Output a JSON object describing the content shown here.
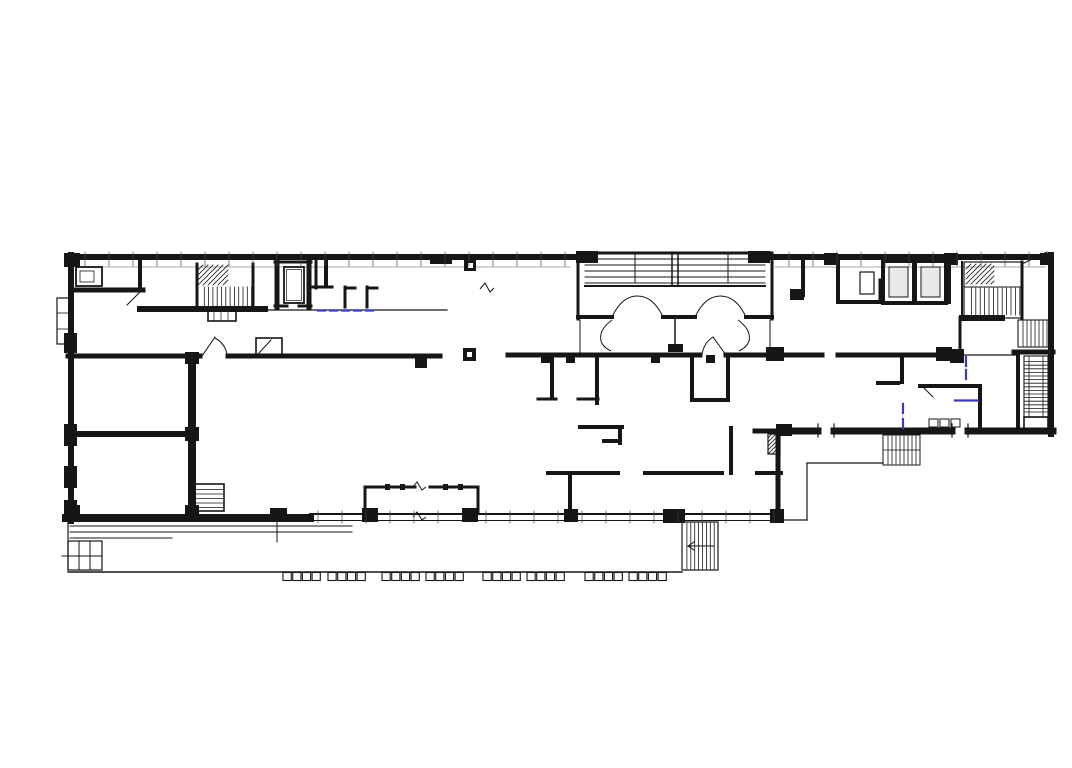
{
  "canvas": {
    "width": 1072,
    "height": 768,
    "background": "#ffffff"
  },
  "colors": {
    "ink": "#161616",
    "gray": "#8a8a8a",
    "blue_annotation": "#3a3ac0",
    "elevator_fill": "#e9e9e9",
    "paper": "#ffffff"
  },
  "floorplan": {
    "walls": [
      [
        68,
        257,
        578,
        257,
        6
      ],
      [
        772,
        257,
        1050,
        257,
        6
      ],
      [
        71,
        255,
        71,
        521,
        6
      ],
      [
        66,
        518,
        310,
        518,
        8
      ],
      [
        1051,
        255,
        1051,
        434,
        6
      ],
      [
        784,
        431,
        818,
        431,
        7
      ],
      [
        834,
        431,
        952,
        431,
        7
      ],
      [
        968,
        431,
        1053,
        431,
        7
      ],
      [
        755,
        431,
        784,
        431,
        5
      ],
      [
        778,
        433,
        778,
        519,
        5
      ],
      [
        578,
        253,
        578,
        319,
        3
      ],
      [
        772,
        253,
        772,
        319,
        3
      ],
      [
        578,
        253,
        772,
        253,
        3
      ],
      [
        578,
        317,
        612,
        317,
        4
      ],
      [
        663,
        317,
        695,
        317,
        4
      ],
      [
        746,
        317,
        772,
        317,
        4
      ],
      [
        72,
        290,
        143,
        290,
        5
      ],
      [
        140,
        258,
        140,
        290,
        4
      ],
      [
        140,
        309,
        265,
        309,
        6
      ],
      [
        197,
        264,
        197,
        308,
        3
      ],
      [
        253,
        264,
        253,
        308,
        3
      ],
      [
        277,
        260,
        277,
        307,
        5
      ],
      [
        309,
        260,
        309,
        307,
        5
      ],
      [
        275,
        262,
        311,
        262,
        3
      ],
      [
        275,
        306,
        287,
        306,
        3
      ],
      [
        299,
        306,
        311,
        306,
        3
      ],
      [
        316,
        258,
        316,
        288,
        3
      ],
      [
        313,
        287,
        332,
        287,
        3
      ],
      [
        326,
        262,
        326,
        286,
        4
      ],
      [
        345,
        307,
        345,
        287,
        3
      ],
      [
        345,
        288,
        355,
        288,
        3
      ],
      [
        367,
        307,
        367,
        287,
        3
      ],
      [
        367,
        288,
        377,
        288,
        3
      ],
      [
        68,
        356,
        200,
        356,
        5
      ],
      [
        228,
        356,
        440,
        356,
        5
      ],
      [
        192,
        356,
        192,
        518,
        8
      ],
      [
        68,
        434,
        192,
        434,
        6
      ],
      [
        508,
        355,
        700,
        355,
        5
      ],
      [
        726,
        355,
        822,
        355,
        5
      ],
      [
        838,
        355,
        952,
        355,
        5
      ],
      [
        552,
        355,
        552,
        398,
        4
      ],
      [
        597,
        355,
        597,
        403,
        4
      ],
      [
        538,
        399,
        556,
        399,
        3
      ],
      [
        578,
        399,
        598,
        399,
        3
      ],
      [
        580,
        427,
        622,
        427,
        4
      ],
      [
        620,
        427,
        620,
        443,
        4
      ],
      [
        620,
        441,
        604,
        441,
        4
      ],
      [
        548,
        473,
        618,
        473,
        4
      ],
      [
        570,
        473,
        570,
        508,
        4
      ],
      [
        645,
        473,
        722,
        473,
        4
      ],
      [
        757,
        473,
        781,
        473,
        4
      ],
      [
        692,
        358,
        692,
        398,
        4
      ],
      [
        692,
        400,
        726,
        400,
        4
      ],
      [
        728,
        358,
        728,
        400,
        4
      ],
      [
        731,
        428,
        731,
        473,
        4
      ],
      [
        902,
        355,
        902,
        382,
        4
      ],
      [
        878,
        383,
        898,
        383,
        4
      ],
      [
        920,
        386,
        980,
        386,
        4
      ],
      [
        980,
        386,
        980,
        428,
        4
      ],
      [
        838,
        258,
        838,
        302,
        4
      ],
      [
        838,
        302,
        882,
        302,
        4
      ],
      [
        880,
        280,
        880,
        302,
        3
      ],
      [
        803,
        258,
        803,
        295,
        4
      ],
      [
        949,
        258,
        949,
        302,
        4
      ],
      [
        962,
        318,
        1002,
        318,
        6
      ],
      [
        962,
        262,
        962,
        318,
        2
      ],
      [
        1022,
        262,
        1022,
        318,
        3
      ],
      [
        960,
        318,
        960,
        356,
        3
      ],
      [
        1014,
        352,
        1053,
        352,
        5
      ],
      [
        1018,
        352,
        1018,
        430,
        4
      ],
      [
        365,
        487,
        415,
        487,
        3
      ],
      [
        430,
        487,
        478,
        487,
        3
      ],
      [
        365,
        487,
        365,
        513,
        3
      ],
      [
        478,
        487,
        478,
        513,
        3
      ]
    ],
    "thin": [
      [
        585,
        259,
        765,
        259,
        1
      ],
      [
        585,
        265,
        765,
        265,
        1
      ],
      [
        585,
        271,
        765,
        271,
        1
      ],
      [
        585,
        277,
        765,
        277,
        1
      ],
      [
        585,
        283,
        765,
        283,
        1
      ],
      [
        585,
        286,
        765,
        286,
        2
      ],
      [
        635,
        255,
        635,
        283,
        1
      ],
      [
        728,
        255,
        728,
        283,
        1
      ],
      [
        672,
        253,
        672,
        285,
        1.5
      ],
      [
        678,
        253,
        678,
        285,
        1.5
      ],
      [
        580,
        320,
        580,
        352,
        1
      ],
      [
        770,
        320,
        770,
        352,
        1
      ],
      [
        675,
        319,
        675,
        348,
        1.5
      ],
      [
        265,
        310,
        447,
        310,
        1.2
      ],
      [
        310,
        514,
        783,
        514,
        2
      ],
      [
        310,
        520.5,
        783,
        520.5,
        1
      ],
      [
        68,
        522,
        68,
        570,
        1.2
      ],
      [
        68,
        572,
        682,
        572,
        1.4
      ],
      [
        70,
        526,
        352,
        526,
        1
      ],
      [
        70,
        532,
        352,
        532,
        1
      ],
      [
        70,
        538,
        172,
        538,
        1
      ],
      [
        79,
        541,
        79,
        570,
        1
      ],
      [
        90,
        541,
        90,
        570,
        1
      ],
      [
        62,
        556,
        102,
        556,
        1
      ],
      [
        277,
        522,
        277,
        542,
        1
      ],
      [
        688,
        546,
        714,
        546,
        1
      ],
      [
        688,
        546,
        694,
        542,
        1
      ],
      [
        688,
        546,
        694,
        550,
        1
      ],
      [
        783,
        520,
        807,
        520,
        1.2
      ],
      [
        807,
        463,
        807,
        520,
        1.2
      ],
      [
        807,
        463,
        883,
        463,
        1.2
      ],
      [
        883,
        450,
        920,
        450,
        0.8
      ],
      [
        818,
        424,
        818,
        437,
        1.2
      ],
      [
        834,
        424,
        834,
        437,
        1.2
      ],
      [
        952,
        424,
        952,
        437,
        1.2
      ],
      [
        968,
        424,
        968,
        437,
        1.2
      ],
      [
        1024,
        263,
        1047,
        252,
        1.2
      ],
      [
        964,
        287,
        1022,
        287,
        1
      ],
      [
        1029,
        357,
        1029,
        416,
        0.8
      ],
      [
        1043,
        357,
        1043,
        416,
        0.8
      ],
      [
        214,
        311,
        214,
        321,
        0.7
      ],
      [
        221,
        311,
        221,
        321,
        0.7
      ],
      [
        228,
        311,
        228,
        321,
        0.7
      ],
      [
        57,
        313,
        69,
        313,
        0.8
      ],
      [
        57,
        329,
        69,
        329,
        0.8
      ],
      [
        202,
        356,
        215,
        337,
        1
      ],
      [
        726,
        355,
        713,
        337,
        1
      ],
      [
        140,
        292,
        127,
        305,
        1
      ],
      [
        922,
        386,
        933,
        397,
        1
      ],
      [
        258,
        354,
        271,
        340,
        1
      ],
      [
        952,
        355,
        1016,
        355,
        1.2
      ]
    ],
    "gray": [
      [
        80,
        267,
        570,
        267,
        0.8
      ],
      [
        775,
        267,
        1045,
        267,
        0.8
      ]
    ],
    "rects": [
      {
        "x": 284,
        "y": 267,
        "w": 20,
        "h": 36,
        "sw": 1.8,
        "fill": "none"
      },
      {
        "x": 286.5,
        "y": 269.5,
        "w": 15,
        "h": 31,
        "sw": 0.7,
        "fill": "none"
      },
      {
        "x": 883,
        "y": 261,
        "w": 31,
        "h": 42,
        "sw": 4,
        "fill": "none"
      },
      {
        "x": 889,
        "y": 267,
        "w": 19,
        "h": 30,
        "sw": 1,
        "fill": "#e9e9e9"
      },
      {
        "x": 915,
        "y": 261,
        "w": 31,
        "h": 42,
        "sw": 4,
        "fill": "none"
      },
      {
        "x": 921,
        "y": 267,
        "w": 19,
        "h": 30,
        "sw": 1,
        "fill": "#e9e9e9"
      },
      {
        "x": 76,
        "y": 267,
        "w": 26,
        "h": 19,
        "sw": 1.8,
        "fill": "none"
      },
      {
        "x": 80,
        "y": 271,
        "w": 14,
        "h": 11,
        "sw": 0.8,
        "fill": "none"
      },
      {
        "x": 256,
        "y": 338,
        "w": 26,
        "h": 18,
        "sw": 1.6,
        "fill": "none"
      },
      {
        "x": 194,
        "y": 484,
        "w": 30,
        "h": 27,
        "sw": 1.6,
        "fill": "none"
      },
      {
        "x": 768,
        "y": 434,
        "w": 12,
        "h": 20,
        "sw": 1.2,
        "fill": "none"
      },
      {
        "x": 208,
        "y": 311,
        "w": 28,
        "h": 10,
        "sw": 1.6,
        "fill": "none"
      },
      {
        "x": 860,
        "y": 272,
        "w": 14,
        "h": 22,
        "sw": 1.2,
        "fill": "none"
      },
      {
        "x": 57,
        "y": 298,
        "w": 12,
        "h": 46,
        "sw": 1.2,
        "fill": "none"
      },
      {
        "x": 68,
        "y": 541,
        "w": 34,
        "h": 29,
        "sw": 1.2,
        "fill": "none"
      },
      {
        "x": 682,
        "y": 522,
        "w": 36,
        "h": 48,
        "sw": 1.2,
        "fill": "none"
      },
      {
        "x": 883,
        "y": 435,
        "w": 37,
        "h": 30,
        "sw": 1,
        "fill": "none"
      },
      {
        "x": 964,
        "y": 262,
        "w": 58,
        "h": 56,
        "sw": 1.2,
        "fill": "none"
      },
      {
        "x": 1018,
        "y": 320,
        "w": 34,
        "h": 27,
        "sw": 1.1,
        "fill": "none"
      },
      {
        "x": 1024,
        "y": 356,
        "w": 24,
        "h": 61,
        "sw": 1.1,
        "fill": "none"
      },
      {
        "x": 1024,
        "y": 417,
        "w": 24,
        "h": 12,
        "sw": 1.6,
        "fill": "none"
      },
      {
        "x": 929,
        "y": 419,
        "w": 9,
        "h": 8,
        "sw": 1,
        "fill": "none"
      },
      {
        "x": 940,
        "y": 419,
        "w": 9,
        "h": 8,
        "sw": 1,
        "fill": "none"
      },
      {
        "x": 951,
        "y": 419,
        "w": 9,
        "h": 8,
        "sw": 1,
        "fill": "none"
      }
    ],
    "blocks": [
      [
        576,
        251,
        22,
        12
      ],
      [
        748,
        251,
        22,
        12
      ],
      [
        430,
        254,
        22,
        10
      ],
      [
        464,
        260,
        12,
        11
      ],
      [
        463,
        348,
        13,
        13
      ],
      [
        766,
        347,
        18,
        14
      ],
      [
        936,
        347,
        16,
        14
      ],
      [
        950,
        349,
        14,
        14
      ],
      [
        541,
        355,
        9,
        8
      ],
      [
        566,
        355,
        9,
        8
      ],
      [
        651,
        355,
        9,
        8
      ],
      [
        706,
        355,
        9,
        8
      ],
      [
        270,
        508,
        17,
        14
      ],
      [
        362,
        508,
        16,
        14
      ],
      [
        462,
        508,
        16,
        14
      ],
      [
        564,
        509,
        14,
        13
      ],
      [
        663,
        509,
        22,
        14
      ],
      [
        770,
        509,
        14,
        14
      ],
      [
        64,
        333,
        13,
        20
      ],
      [
        64,
        424,
        13,
        22
      ],
      [
        64,
        466,
        13,
        22
      ],
      [
        64,
        500,
        13,
        20
      ],
      [
        64,
        253,
        16,
        14
      ],
      [
        185,
        352,
        14,
        12
      ],
      [
        185,
        427,
        14,
        14
      ],
      [
        185,
        505,
        14,
        13
      ],
      [
        64,
        505,
        16,
        15
      ],
      [
        668,
        344,
        15,
        8
      ],
      [
        790,
        289,
        14,
        11
      ],
      [
        776,
        424,
        16,
        12
      ],
      [
        824,
        253,
        14,
        12
      ],
      [
        944,
        253,
        14,
        12
      ],
      [
        1040,
        253,
        13,
        12
      ],
      [
        385,
        484,
        5,
        6
      ],
      [
        400,
        484,
        5,
        6
      ],
      [
        443,
        484,
        5,
        6
      ],
      [
        458,
        484,
        5,
        6
      ],
      [
        415,
        358,
        12,
        10
      ]
    ],
    "white_rects": [
      [
        467,
        352,
        5,
        5
      ],
      [
        468,
        263,
        5,
        5
      ]
    ],
    "hatches": [
      {
        "x": 198,
        "y": 265,
        "w": 30,
        "h": 20,
        "dir": "d",
        "step": 5
      },
      {
        "x": 200,
        "y": 287,
        "w": 52,
        "h": 21,
        "dir": "v",
        "step": 4.3
      },
      {
        "x": 195,
        "y": 485,
        "w": 28,
        "h": 25,
        "dir": "h",
        "step": 4.5
      },
      {
        "x": 966,
        "y": 264,
        "w": 28,
        "h": 20,
        "dir": "d",
        "step": 5
      },
      {
        "x": 967,
        "y": 288,
        "w": 53,
        "h": 27,
        "dir": "v",
        "step": 4.4
      },
      {
        "x": 1019,
        "y": 321,
        "w": 32,
        "h": 25,
        "dir": "v",
        "step": 4
      },
      {
        "x": 1025,
        "y": 358,
        "w": 22,
        "h": 57,
        "dir": "h",
        "step": 3.6
      },
      {
        "x": 683,
        "y": 523,
        "w": 34,
        "h": 46,
        "dir": "v",
        "step": 3.9
      },
      {
        "x": 884,
        "y": 436,
        "w": 35,
        "h": 28,
        "dir": "v",
        "step": 4
      },
      {
        "x": 768,
        "y": 434,
        "w": 12,
        "h": 20,
        "dir": "d",
        "step": 4
      }
    ],
    "paths": [
      "M612 317 C619 302 628 296 637.5 296 C647 296 656 302 663 317",
      "M695 317 C702 302 711 296 720.5 296 C730 296 739 302 746 317",
      "M612 320 C598 330 596 344 611 351",
      "M738 320 C752 330 754 344 739 351",
      "M215 338 A24 24 0 0 1 227 354",
      "M713 337 A25 25 0 0 0 702 355",
      "M413 487 l4 -5 l5 8 l4 -3",
      "M413 517 l4 -5 l5 8 l4 -3",
      "M480 289 l5 -6 l5 9 l4 -4"
    ],
    "blue_marks": [
      {
        "x1": 318,
        "y1": 310.5,
        "x2": 378,
        "y2": 310.5,
        "dash": "7,5"
      },
      {
        "x1": 966,
        "y1": 357,
        "x2": 966,
        "y2": 383,
        "dash": "9,4"
      },
      {
        "x1": 955,
        "y1": 400.5,
        "x2": 978,
        "y2": 400.5,
        "dash": ""
      },
      {
        "x1": 903,
        "y1": 404,
        "x2": 903,
        "y2": 431,
        "dash": "9,6"
      }
    ],
    "tick_rows": [
      {
        "y1": 252,
        "y2": 266,
        "xs": [
          85,
          109,
          133,
          157,
          181,
          205,
          229,
          253,
          277,
          301,
          325,
          349,
          373,
          397,
          421,
          445,
          469,
          493,
          517,
          541,
          565
        ]
      },
      {
        "y1": 252,
        "y2": 266,
        "xs": [
          789,
          813,
          837,
          861,
          885,
          909,
          933,
          957,
          981,
          1005,
          1029
        ]
      },
      {
        "y1": 511,
        "y2": 523,
        "xs": [
          318,
          342,
          366,
          390,
          414,
          438,
          486,
          510,
          534,
          558,
          582,
          606,
          630,
          654,
          678,
          702,
          726,
          750,
          774
        ]
      }
    ],
    "teeth": {
      "y": 572.5,
      "h": 8,
      "cell_w": 8.2,
      "cell_step": 9.7,
      "cells": 4,
      "groups": [
        283,
        328,
        382,
        426,
        483,
        527,
        585,
        629
      ]
    }
  }
}
